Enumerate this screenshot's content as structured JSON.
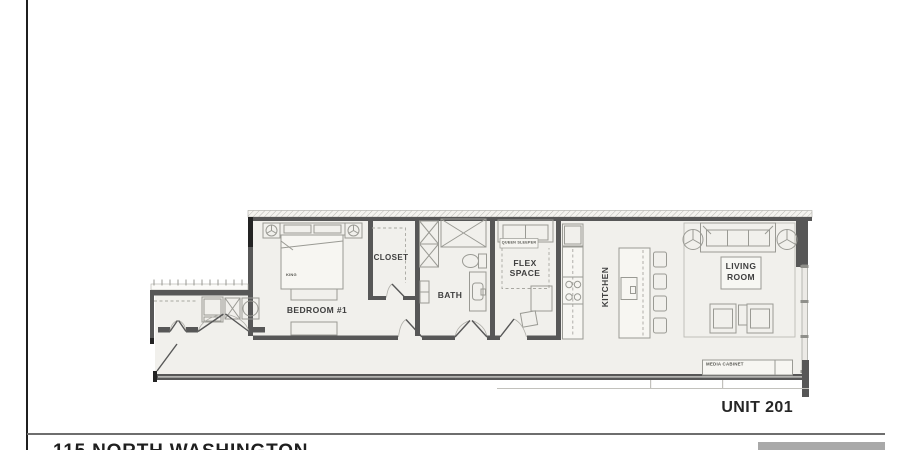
{
  "sheet": {
    "address": "115 NORTH WASHINGTON",
    "unit_label": "UNIT 201"
  },
  "plan": {
    "labels": {
      "bedroom": "BEDROOM #1",
      "closet": "CLOSET",
      "bath": "BATH",
      "flex_line1": "FLEX",
      "flex_line2": "SPACE",
      "kitchen": "KITCHEN",
      "living_line1": "LIVING",
      "living_line2": "ROOM",
      "king": "KING",
      "queen_sleeper": "QUEEN SLEEPER",
      "media_cabinet": "MEDIA CABINET"
    },
    "colors": {
      "wall": "#575757",
      "wall_dark": "#232323",
      "floor": "#f1f0ec",
      "line": "#9a9a94",
      "footer_bar": "#a9a9a9"
    }
  }
}
